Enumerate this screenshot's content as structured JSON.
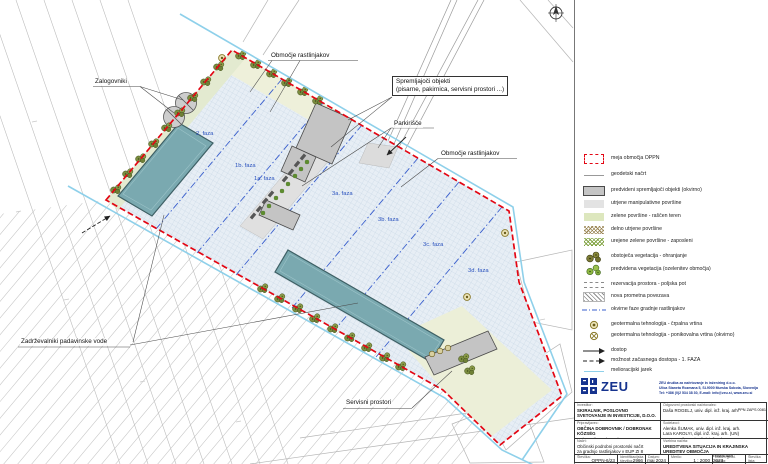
{
  "map": {
    "callouts": {
      "zalogovniki": "Zalogovniki",
      "area_top": "Območje rastlinjakov",
      "accompany1": "Spremljajoči objekti",
      "accompany2": "(pisarne, pakirnica, servisni prostori ...)",
      "parking": "Parkirišče",
      "area_right": "Območje rastlinjakov",
      "retention": "Zadrževalniki padavinske vode",
      "service": "Servisni prostori"
    },
    "phase_labels": [
      "2. faza",
      "1b. faza",
      "1a. faza",
      "3a. faza",
      "3b. faza",
      "3c. faza",
      "3d. faza"
    ]
  },
  "legend": {
    "items": [
      {
        "key": "oppn-boundary",
        "label": "meja območja OPPN"
      },
      {
        "key": "geodetic-plan",
        "label": "geodetski načrt"
      },
      {
        "key": "planned-buildings",
        "label": "predvideni spremljajoči objekti (okvirno)"
      },
      {
        "key": "paved-surfaces",
        "label": "utrjene manipulativne površine"
      },
      {
        "key": "green-surfaces",
        "label": "zelene površine - raščen teren"
      },
      {
        "key": "semi-paved",
        "label": "delno utrjene površine"
      },
      {
        "key": "green-employees",
        "label": "urejene zelene površine - zaposleni"
      },
      {
        "key": "existing-vegetation",
        "label": "obstoječa vegetacija - ohranjanje"
      },
      {
        "key": "planned-vegetation",
        "label": "predvidena vegetacija (ozelenitev območja)"
      },
      {
        "key": "space-reservation",
        "label": "rezervacija prostora - poljska pot"
      },
      {
        "key": "new-road",
        "label": "nova prometna povezava"
      },
      {
        "key": "greenhouse-phases",
        "label": "okvirne faze gradnje rastlinjakov"
      },
      {
        "key": "geothermal-pump-well",
        "label": "geotermalna tehnologija - črpalna vrtina"
      },
      {
        "key": "geothermal-inject-well",
        "label": "geotermalna tehnologija - ponikovalna vrtina (okvirno)"
      },
      {
        "key": "access",
        "label": "dostop"
      },
      {
        "key": "temp-access",
        "label": "možnost začasnega dostopa - 1. FAZA"
      },
      {
        "key": "melioration-ditch",
        "label": "melioracijski jarek"
      }
    ]
  },
  "brand": {
    "name": "ZEU",
    "line1": "ZEU družba za načrtovanje in inženiring d.o.o.",
    "line2": "Ulica Staneta Rozmana 5, SI-9000 Murska Sobota, Slovenija",
    "line3": "Tel: +386 (0)2 534 38 30, E-mail: info@zeu.si, www.zeu.si"
  },
  "titleblock": {
    "investor_label": "Investitor:",
    "investor_name": "SKIRALNIK, POSLOVNO SVETOVANJE IN INVESTICIJE, D.O.O.",
    "investor_address": "Cvetkova ulica 29, 1000 Ljubljana",
    "preparer_label": "Pripravljavec:",
    "preparer_name": "OBČINA DOBROVNIK / DOBRONAK KÖZSÉG",
    "preparer_address": "Dobrovnik - Dobronak 297, 9223 Dobrovnik/Dobronak",
    "plan_label": "Načrt:",
    "plan_line1": "Občinski podrobni prostorski načrt",
    "plan_line2": "za gradnjo rastlinjakov v EUP ZI 8",
    "designer_label": "Odgovorni prostorski načrtovalec:",
    "designer_name": "Daša ROGELJ, univ. dipl. inž. kraj. arh.",
    "designer_id": "PPN ZAPS 0081",
    "collab_label": "Sodelavci:",
    "collab1": "Alenka ŠUMAK, univ. dipl. inž. kraj. arh.",
    "collab2": "Lara KAROLYI, dipl. inž. kraj. arh. (UN)",
    "collab3": "Leon CIGÜT, univ. dipl. inž. arh.",
    "content_label": "Vsebina načrta:",
    "content_line1": "UREDITVENA SITUACIJA IN KRAJINSKA",
    "content_line2": "UREDITEV OBMOČJA",
    "cells": [
      {
        "label": "Številka:",
        "value": "OPPN-6/23"
      },
      {
        "label": "Identifikacijska številka:",
        "value": "2966"
      },
      {
        "label": "Datum:",
        "value": "maj 2024"
      },
      {
        "label": "Merilo:",
        "value": "1 : 2000"
      },
      {
        "label": "Datum geod. načrta:",
        "value": "november 2023"
      },
      {
        "label": "Številka lista:",
        "value": ""
      }
    ]
  },
  "colors": {
    "boundary_red": "#e30613",
    "phase_blue": "#2a52be",
    "ditch_cyan": "#8ed0ea",
    "basin_teal": "#7aa9b0",
    "greenhouse_fill": "#e7eef5",
    "brand_blue": "#16338e"
  }
}
